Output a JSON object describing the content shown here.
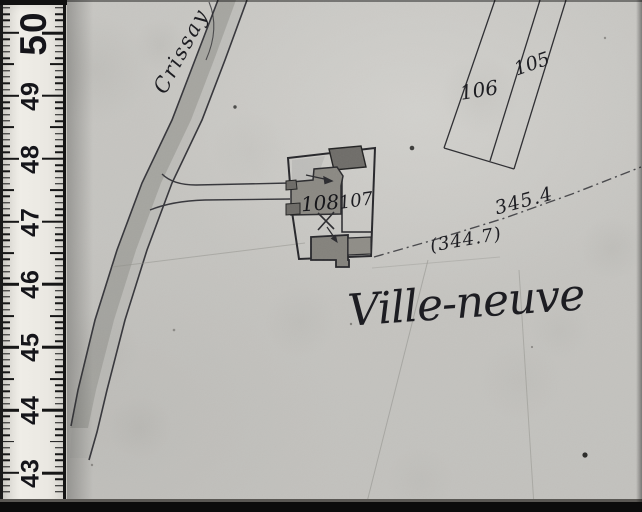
{
  "ruler": {
    "unit_numbers": [
      "50",
      "49",
      "48",
      "47",
      "46",
      "45",
      "44",
      "43"
    ]
  },
  "map": {
    "road_name": "Crissay",
    "place_name": "Ville-neuve",
    "parcel_numbers": {
      "p105": "105",
      "p106": "106",
      "p107": "107",
      "p108": "108"
    },
    "elevations": {
      "upper": "345.4",
      "lower": "(344.7)"
    }
  },
  "colors": {
    "paper": "#c6c5c1",
    "ink": "#26262a",
    "road_wash": "#92928d",
    "building_dark": "#6f6d69",
    "building_mid": "#8b8983",
    "ruler_face": "#eae8e2",
    "frame_black": "#0c0c0c"
  }
}
